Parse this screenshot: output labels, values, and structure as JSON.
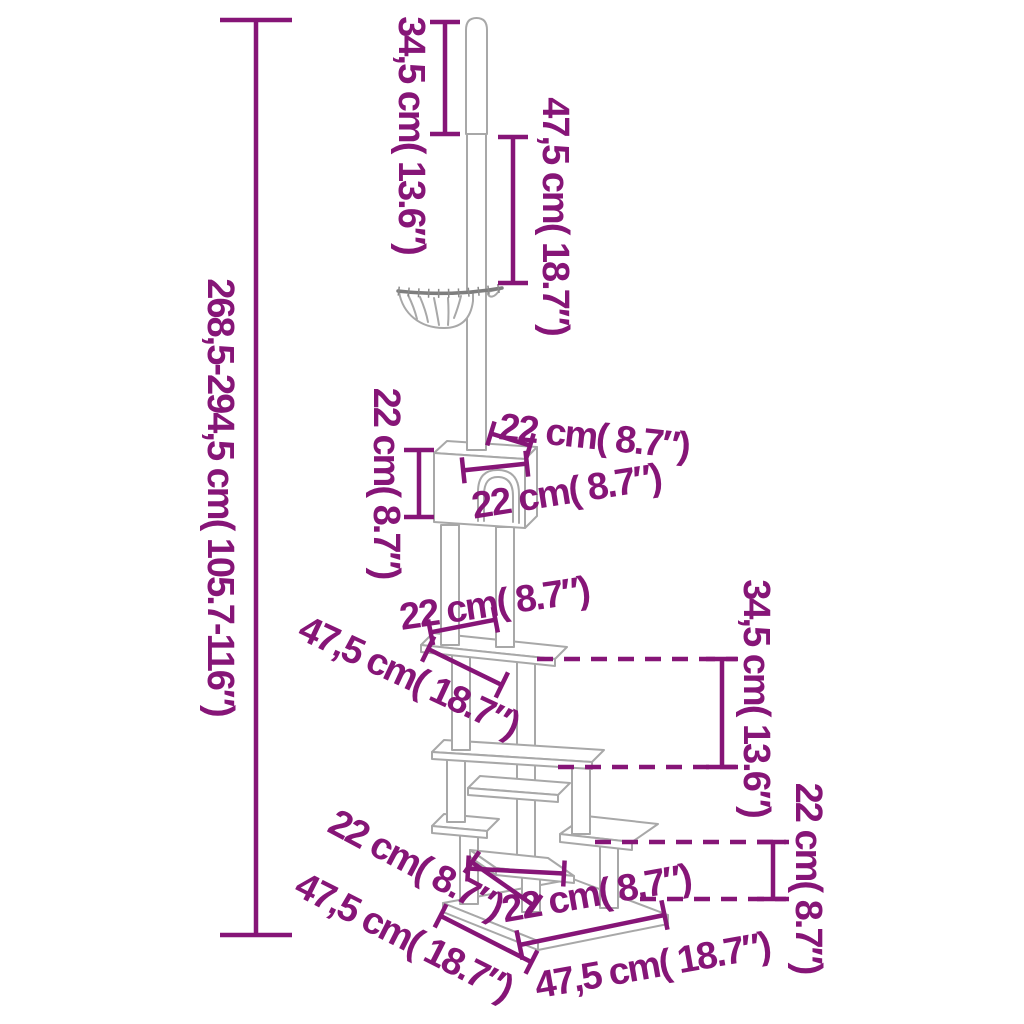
{
  "colors": {
    "dimension_accent": "#861577",
    "artwork_line": "#a8a8a8",
    "background": "#ffffff"
  },
  "annotations": {
    "total_height": {
      "label": "268,5-294,5 cm( 105.7-116″)"
    },
    "ceiling_pole_section": {
      "label": "34,5 cm( 13.6″)"
    },
    "upper_pole_section": {
      "label": "47,5 cm( 18.7″)"
    },
    "condo_height": {
      "label": "22 cm( 8.7″)"
    },
    "condo_top_depth": {
      "label": "22 cm( 8.7″)"
    },
    "condo_width": {
      "label": "22 cm( 8.7″)"
    },
    "post_spacing": {
      "label": "22 cm( 8.7″)"
    },
    "main_platform_length": {
      "label": "47,5 cm( 18.7″)"
    },
    "platform_drop": {
      "label": "34,5 cm( 13.6″)"
    },
    "step_drop": {
      "label": "22 cm( 8.7″)"
    },
    "step_depth_diagonal": {
      "label": "22 cm( 8.7″)"
    },
    "bottom_step_width": {
      "label": "22 cm( 8.7″)"
    },
    "base_depth": {
      "label": "47,5 cm( 18.7″)"
    },
    "base_width": {
      "label": "47,5 cm( 18.7″)"
    }
  }
}
